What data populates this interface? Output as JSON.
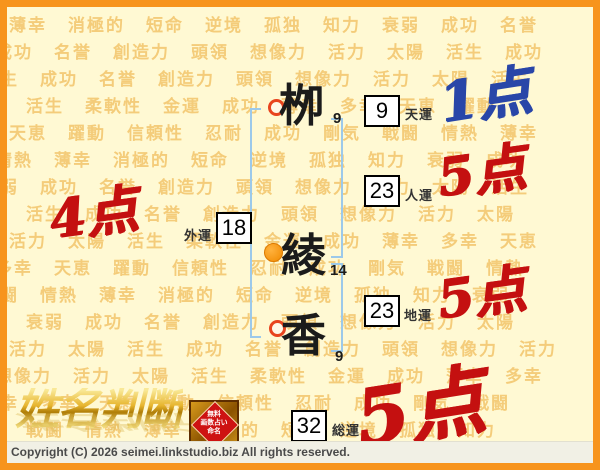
{
  "page": {
    "background_color": "#FFF9D3",
    "border_color": "#F7941D"
  },
  "background_pattern": {
    "color": "#F2C46A",
    "words": [
      "薄幸",
      "消極的",
      "短命",
      "逆境",
      "孤独",
      "知力",
      "衰弱",
      "成功",
      "名誉",
      "創造力",
      "頭領",
      "想像力",
      "活力",
      "太陽",
      "活生",
      "成功",
      "名誉",
      "創造力",
      "頭領",
      "想像力",
      "活力",
      "太陽",
      "活生",
      "柔軟性",
      "金運",
      "成功",
      "薄幸",
      "多幸",
      "天恵",
      "躍動",
      "信頼性",
      "忍耐",
      "成功",
      "剛気",
      "戦闘",
      "情熱"
    ]
  },
  "name": {
    "characters": [
      {
        "char": "栁",
        "strokes": "9",
        "marker": "red-ring"
      },
      {
        "char": "綾",
        "strokes": "14",
        "marker": "orange-dot"
      },
      {
        "char": "香",
        "strokes": "9",
        "marker": "red-ring"
      }
    ]
  },
  "fortunes": [
    {
      "label": "天運",
      "value": "9",
      "score": "1点",
      "score_color": "#2946A8"
    },
    {
      "label": "人運",
      "value": "23",
      "score": "5点",
      "score_color": "#C41010"
    },
    {
      "label": "外運",
      "value": "18",
      "score": "4点",
      "score_color": "#C41010"
    },
    {
      "label": "地運",
      "value": "23",
      "score": "5点",
      "score_color": "#C41010"
    },
    {
      "label": "総運",
      "value": "32",
      "score": "5点",
      "score_color": "#C41010"
    }
  ],
  "logo": {
    "text": "姓名判断"
  },
  "stamp": {
    "lines": [
      "無料",
      "画数占い",
      "命名"
    ]
  },
  "footer": {
    "copyright": "Copyright (C) 2026 seimei.linkstudio.biz All rights reserved."
  }
}
